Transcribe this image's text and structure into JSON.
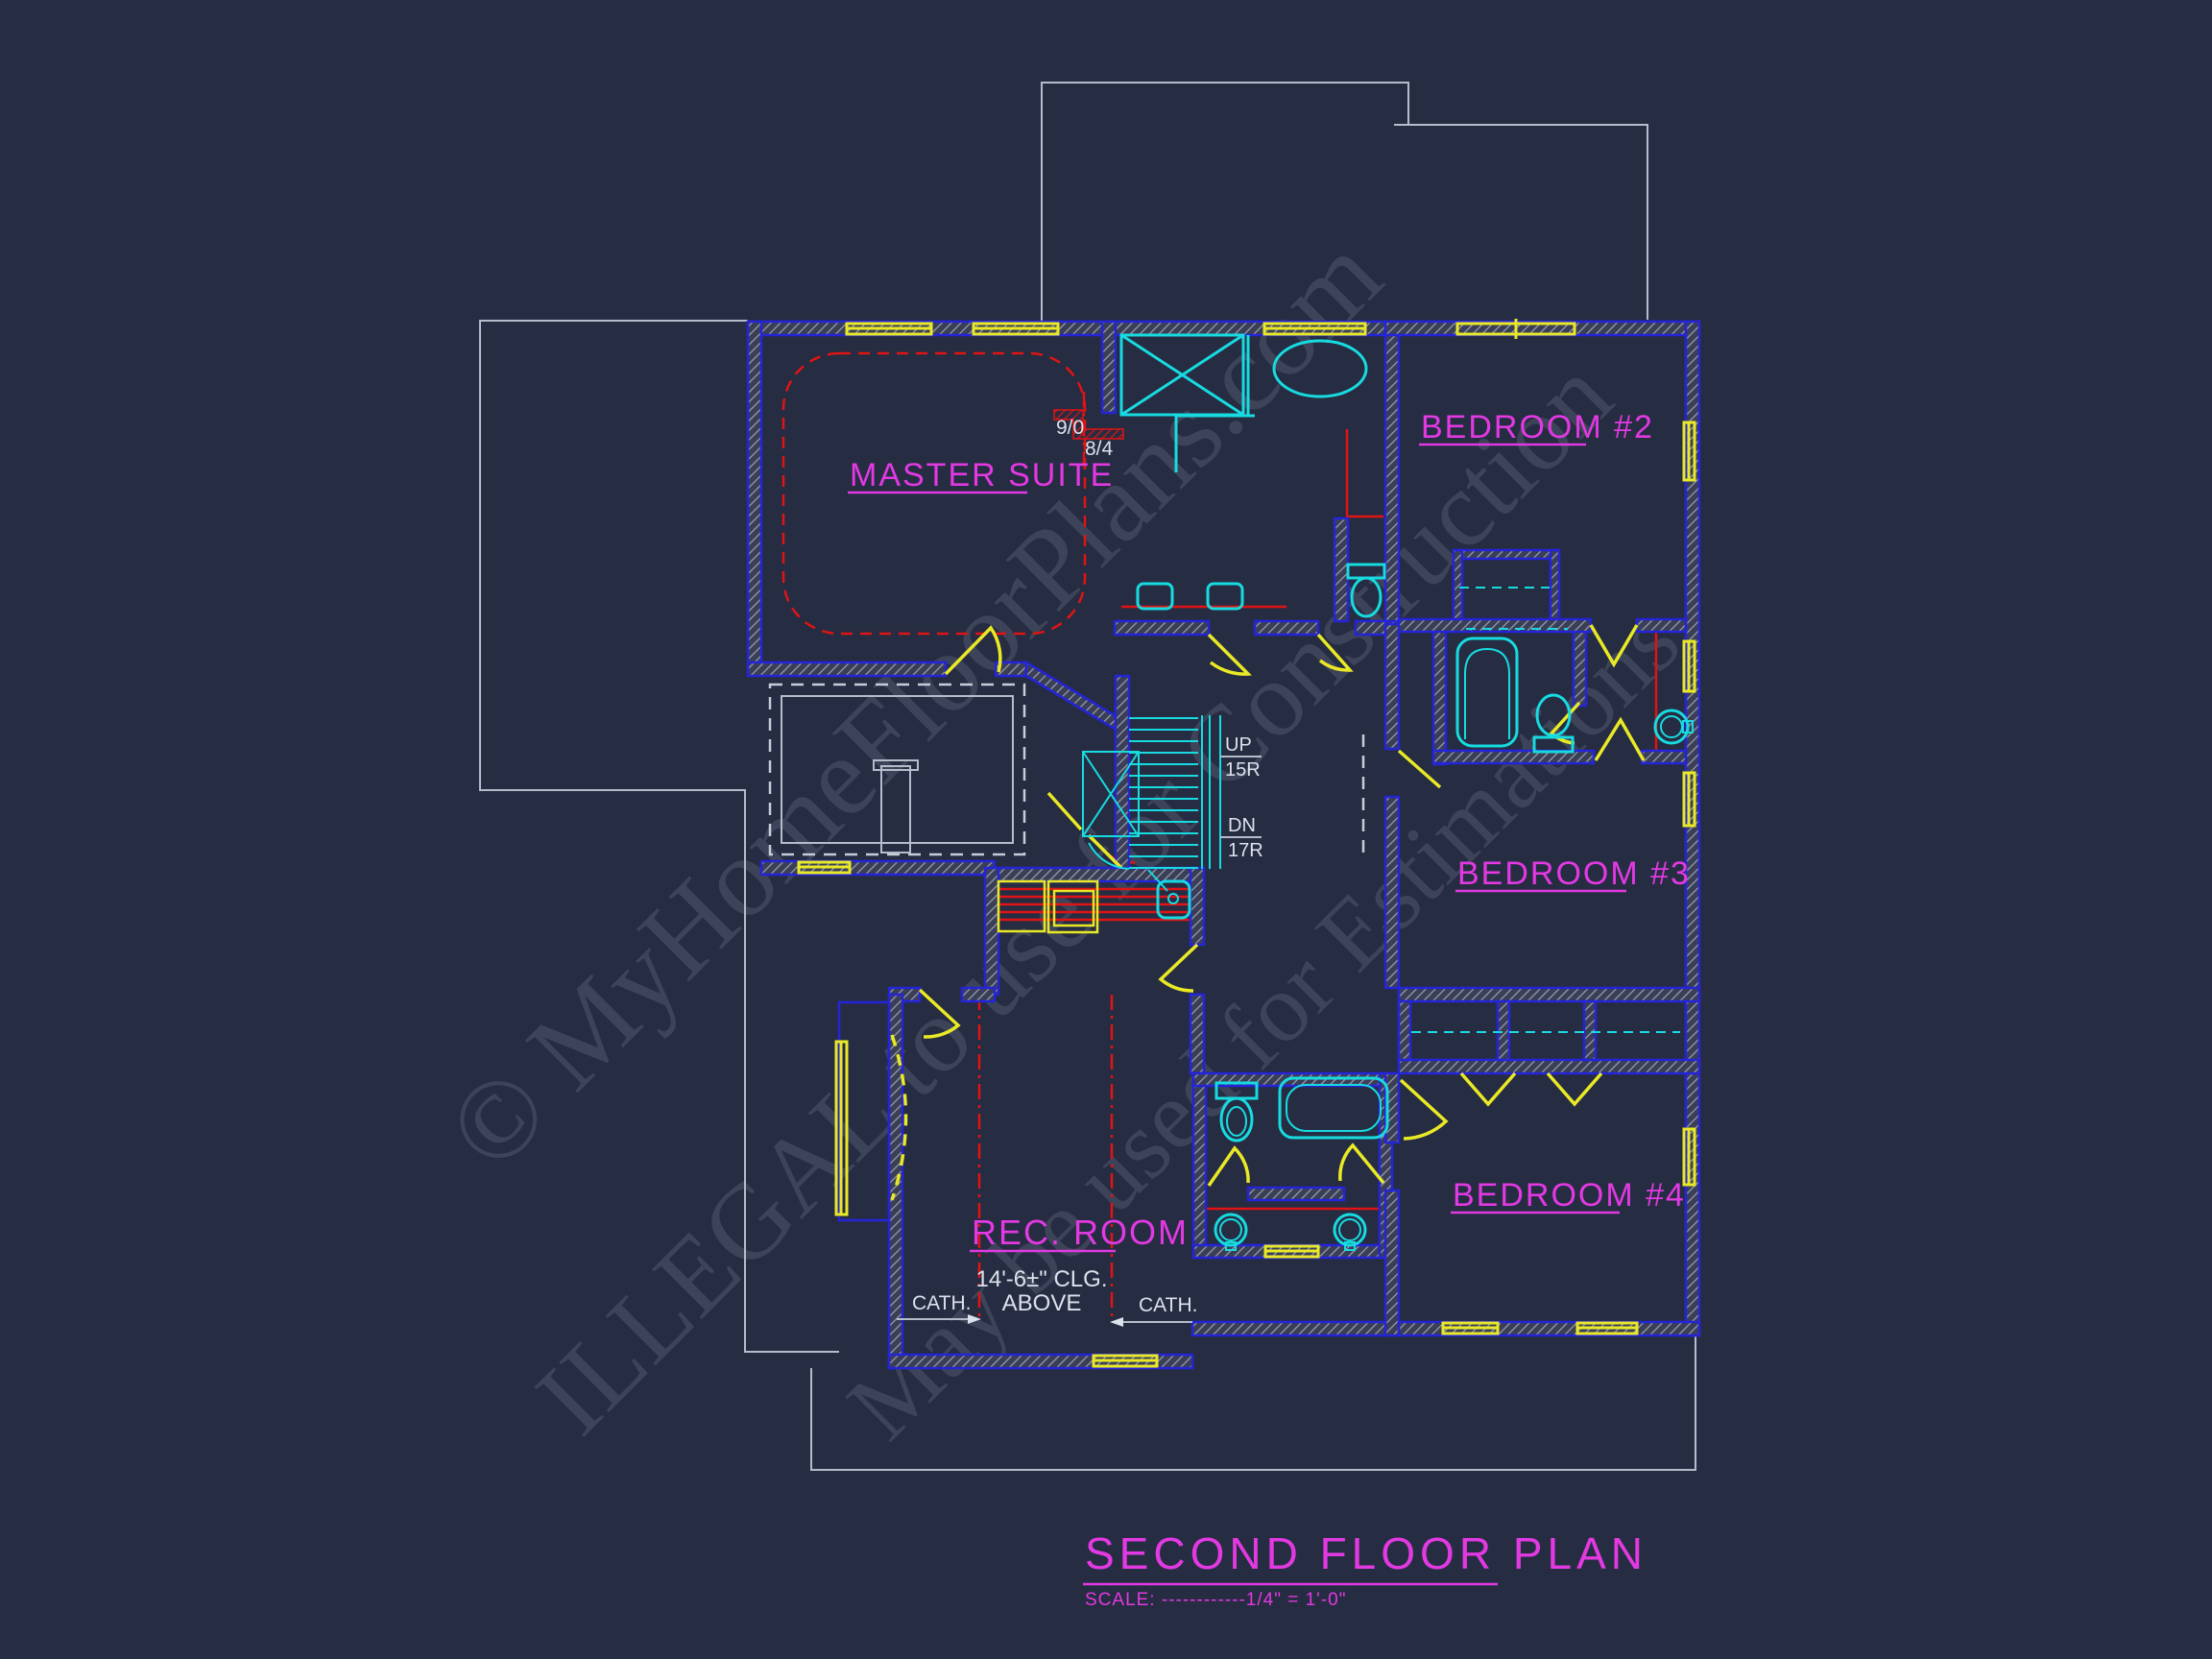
{
  "plan": {
    "rooms": {
      "master": "MASTER SUITE",
      "bedroom2": "BEDROOM #2",
      "bedroom3": "BEDROOM #3",
      "bedroom4": "BEDROOM #4",
      "rec_room": "REC. ROOM"
    },
    "annotations": {
      "door_width_a": "9/0",
      "door_width_b": "8/4",
      "stair_up": "UP",
      "stair_up_risers": "15R",
      "stair_down": "DN",
      "stair_down_risers": "17R",
      "cath_left": "CATH.",
      "cath_right": "CATH.",
      "ceiling_note_line1": "14'-6±\" CLG.",
      "ceiling_note_line2": "ABOVE"
    }
  },
  "title_block": {
    "title": "SECOND FLOOR PLAN",
    "scale_note": "SCALE: ------------1/4\" = 1'-0\""
  },
  "watermark": {
    "line1": "© MyHomeFloorPlans.com",
    "line2": "ILLEGAL to use for Construction",
    "line3": "May be used for Estimations"
  },
  "colors": {
    "background": "#262c42",
    "wall_blue": "#2424d8",
    "window_yellow": "#e9e926",
    "fixture_cyan": "#17dbe0",
    "ceiling_red": "#e01414",
    "label_magenta": "#e239e2",
    "outline_gray": "#b7bccb",
    "watermark_gray": "#3d4459"
  }
}
